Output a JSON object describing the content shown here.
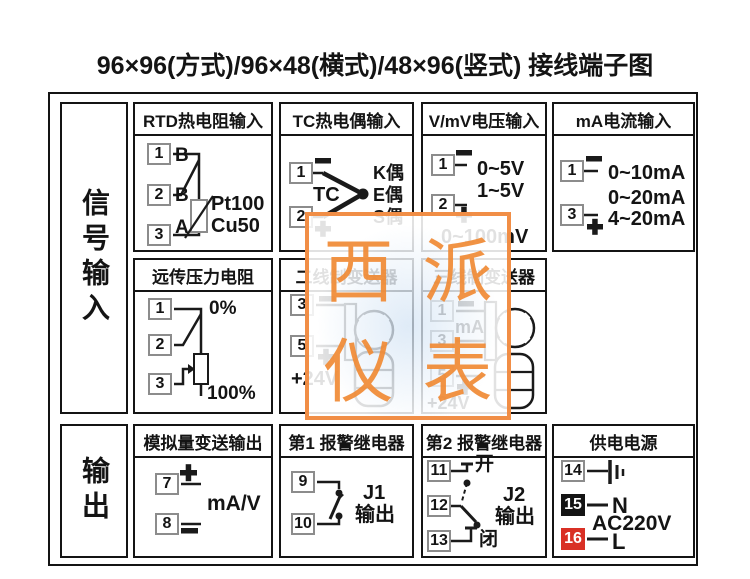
{
  "title": "96×96(方式)/96×48(横式)/48×96(竖式) 接线端子图",
  "sidebar": {
    "input_label": "信号输入",
    "output_label": "输出"
  },
  "watermark": {
    "chars": [
      "西",
      "派",
      "仪",
      "表"
    ]
  },
  "boxes": {
    "rtd": {
      "title": "RTD热电阻输入",
      "terminals": [
        "1",
        "2",
        "3"
      ],
      "wire_tags": [
        "B",
        "B",
        "A"
      ],
      "sensor_types": [
        "Pt100",
        "Cu50"
      ]
    },
    "tc": {
      "title": "TC热电偶输入",
      "terminals": [
        "1",
        "2"
      ],
      "tc_label": "TC",
      "couple_types": [
        "K偶",
        "E偶",
        "S偶"
      ]
    },
    "volt": {
      "title": "V/mV电压输入",
      "terminals": [
        "1",
        "2"
      ],
      "ranges": [
        "0~5V",
        "1~5V",
        "0~100mV"
      ]
    },
    "ma": {
      "title": "mA电流输入",
      "terminals": [
        "1",
        "3"
      ],
      "ranges": [
        "0~10mA",
        "0~20mA",
        "4~20mA"
      ]
    },
    "pressure": {
      "title": "远传压力电阻",
      "terminals": [
        "1",
        "2",
        "3"
      ],
      "top_label": "0%",
      "bottom_label": "100%"
    },
    "two_wire": {
      "title": "二线制变送器",
      "terminals": [
        "3",
        "5"
      ],
      "supply_label": "+24V"
    },
    "three_wire": {
      "title": "三线制变送器",
      "terminals": [
        "1",
        "3",
        "5"
      ],
      "ma_label": "mA",
      "supply_label": "+24V"
    },
    "analog_out": {
      "title": "模拟量变送输出",
      "terminals": [
        "7",
        "8"
      ],
      "signal_label": "mA/V"
    },
    "relay1": {
      "title": "第1 报警继电器",
      "terminals": [
        "9",
        "10"
      ],
      "relay_name": "J1",
      "output_label": "输出"
    },
    "relay2": {
      "title": "第2 报警继电器",
      "terminals": [
        "11",
        "12",
        "13"
      ],
      "open_label": "开",
      "close_label": "闭",
      "relay_name": "J2",
      "output_label": "输出"
    },
    "power": {
      "title": "供电电源",
      "terminals": [
        "14",
        "15",
        "16"
      ],
      "neutral_label": "N",
      "live_label": "L",
      "voltage_label": "AC220V"
    }
  }
}
